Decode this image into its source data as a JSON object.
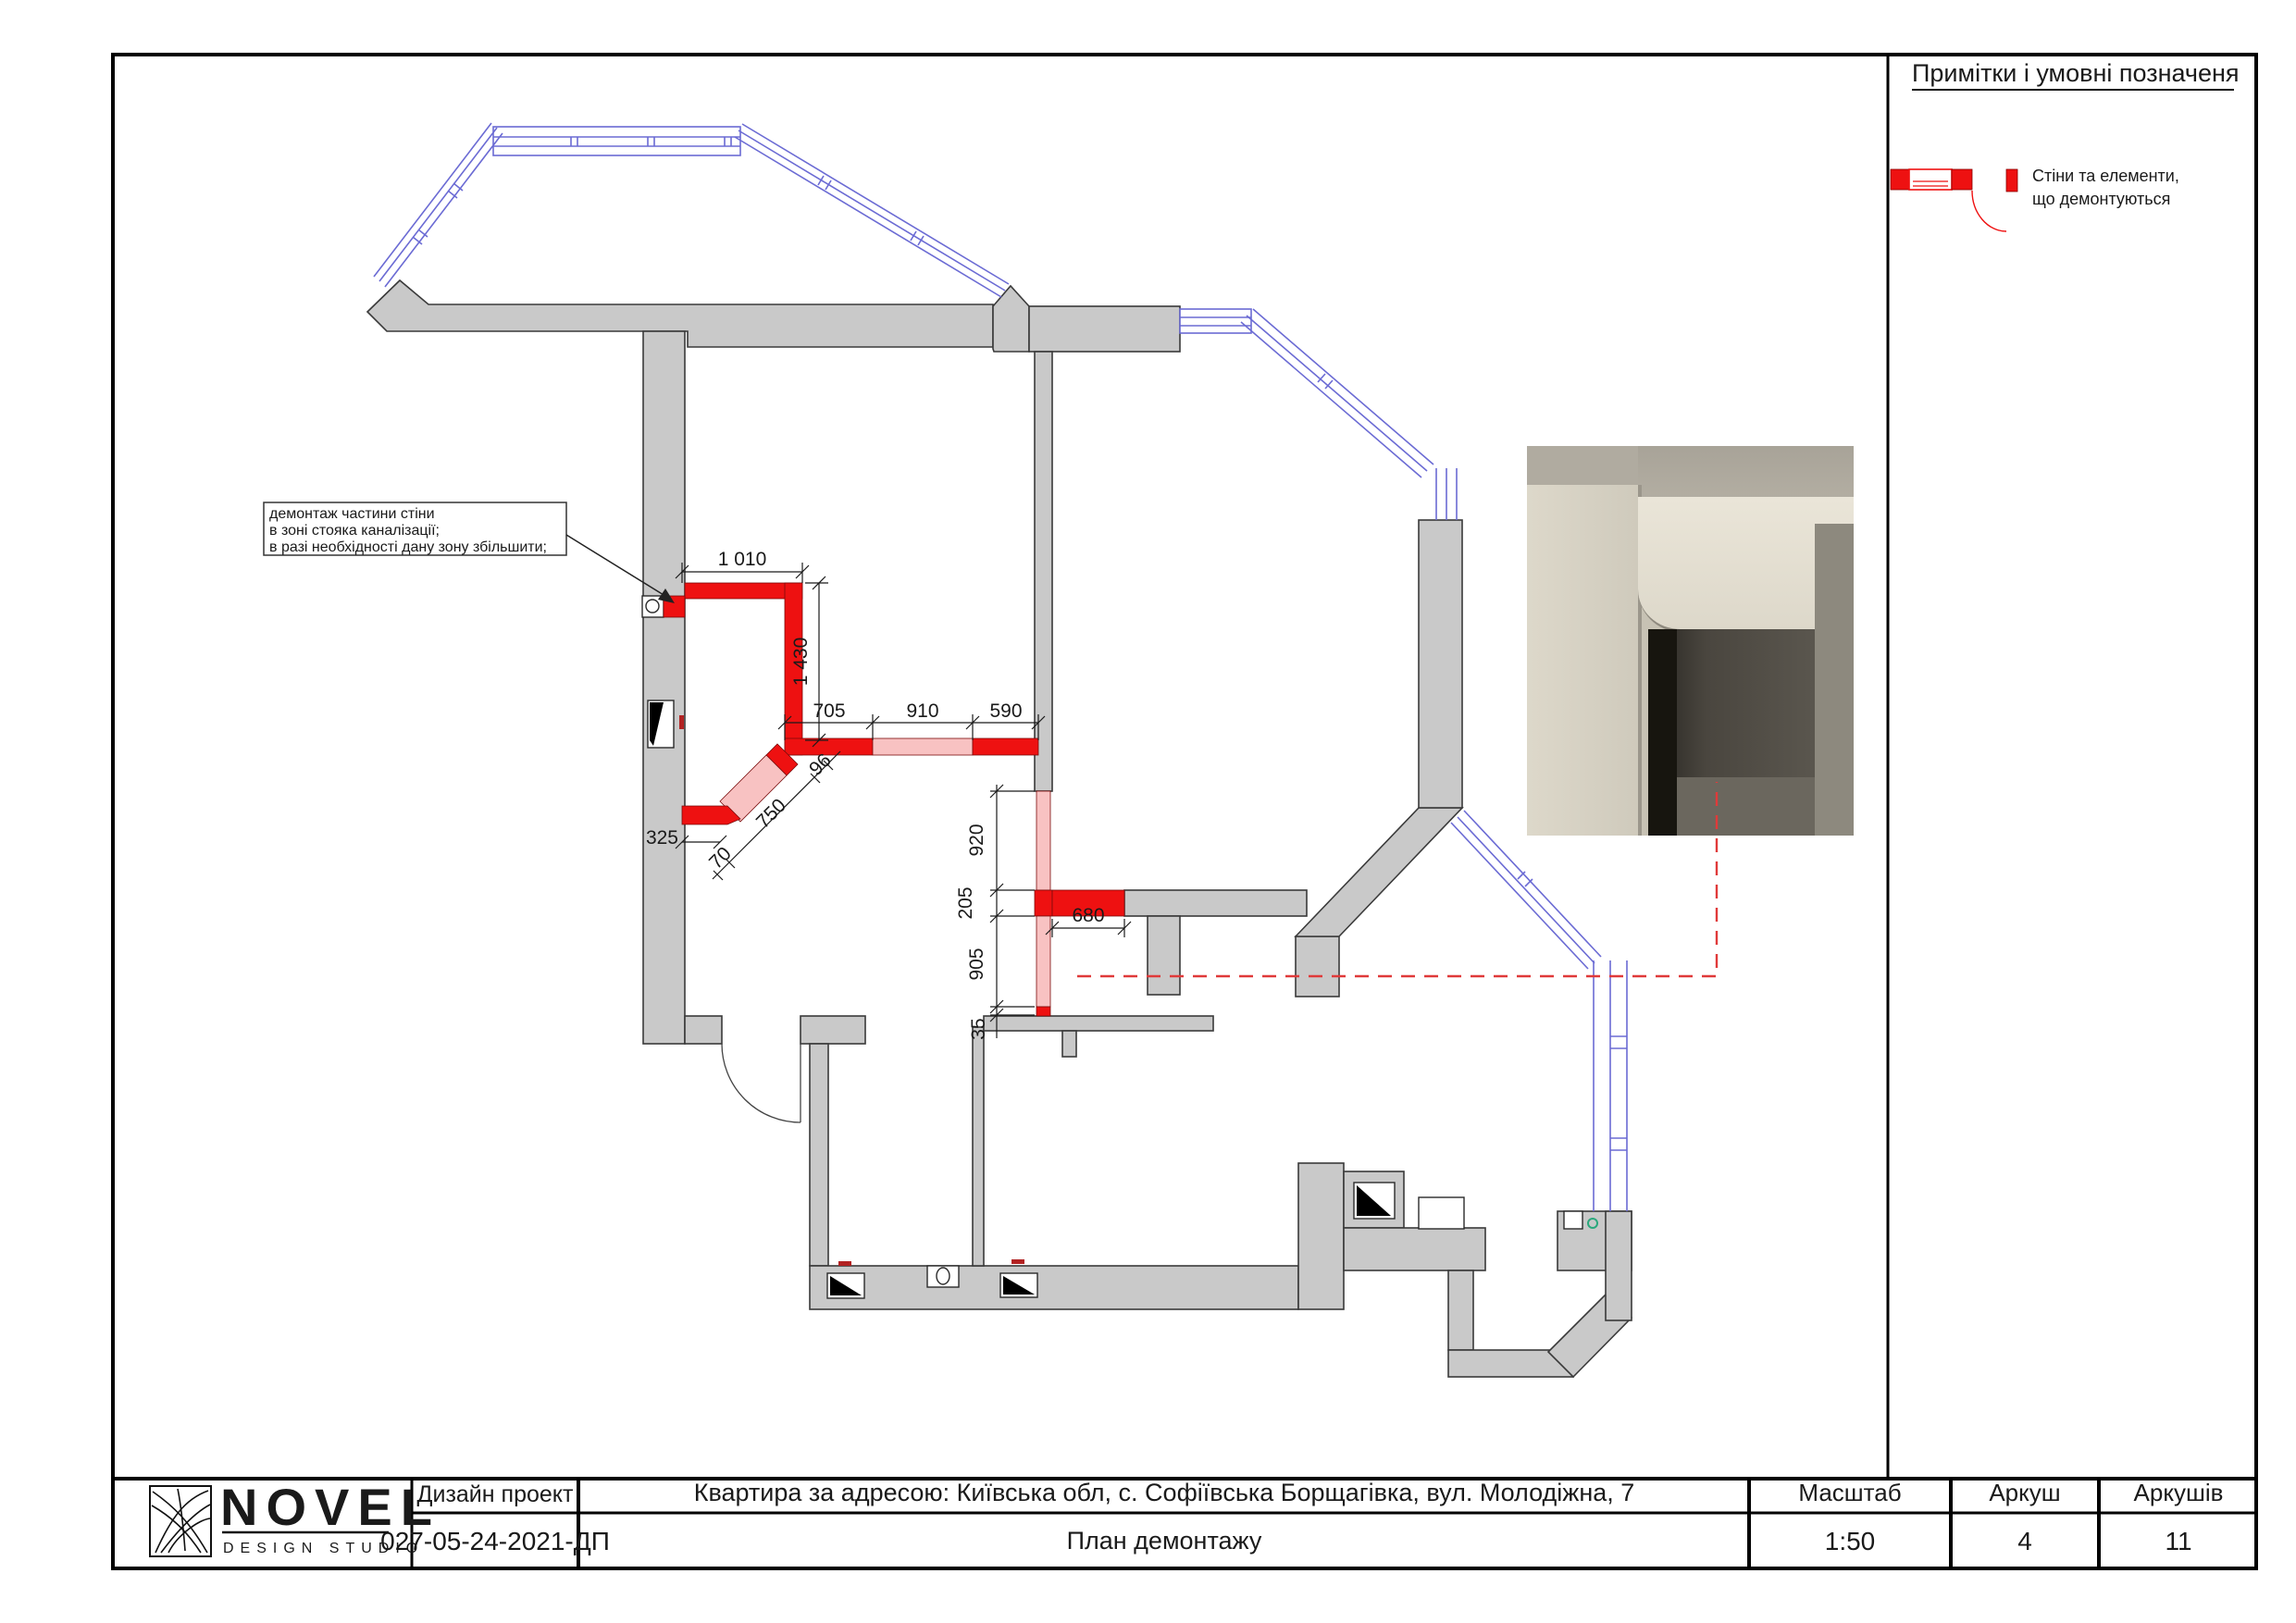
{
  "colors": {
    "wall_gray": "#c9c9c9",
    "wall_stroke": "#3a3a3a",
    "demolition_red": "#ee1111",
    "demolition_pink": "#f8c2c2",
    "window_blue": "#6b6bd4",
    "leader_dashed_red": "#e03a3a"
  },
  "legend": {
    "title": "Примітки і умовні позначеня",
    "items": [
      {
        "icon": "demolished-wall-symbol",
        "line1": "Стіни та елементи,",
        "line2": "що демонтуються"
      }
    ]
  },
  "annotation": {
    "line1": "демонтаж частини стіни",
    "line2": "в зоні стояка каналізації;",
    "line3": "в разі необхідності дану зону збільшити;"
  },
  "dimensions": {
    "top_width": "1 010",
    "right_height": "1 430",
    "seg_705": "705",
    "seg_910": "910",
    "seg_590": "590",
    "left_offset": "325",
    "diag_70": "70",
    "diag_750": "750",
    "diag_96": "96",
    "v_920": "920",
    "v_205": "205",
    "v_905": "905",
    "v_35": "35",
    "opening_680": "680"
  },
  "title_block": {
    "company": "NOVEL",
    "company_sub": "DESIGN STUDIO",
    "project_type": "Дизайн проект",
    "project_code": "027-05-24-2021-ДП",
    "address": "Квартира за адресою: Київська обл, с. Софіївська Борщагівка, вул. Молодіжна, 7",
    "sheet_title": "План демонтажу",
    "scale_label": "Масштаб",
    "scale_value": "1:50",
    "sheet_label": "Аркуш",
    "sheet_value": "4",
    "sheets_label": "Аркушів",
    "sheets_value": "11"
  }
}
